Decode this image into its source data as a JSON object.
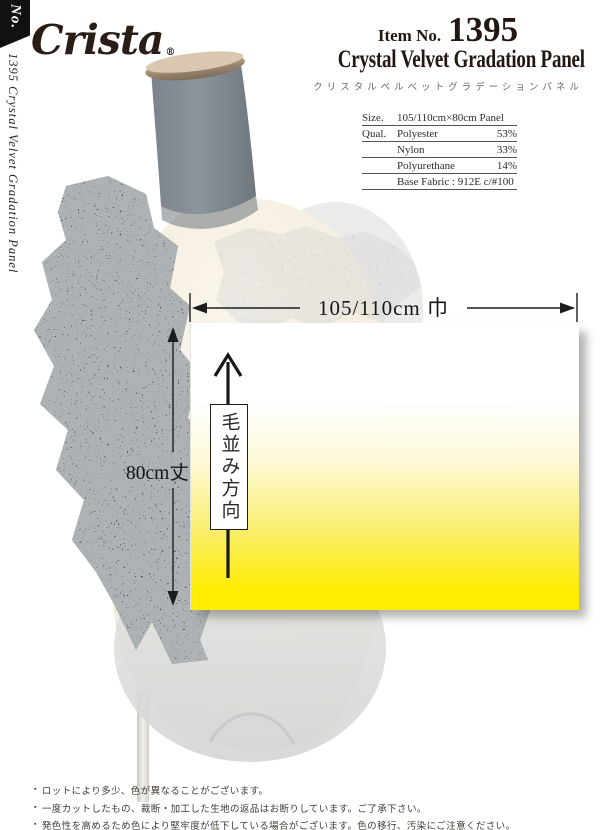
{
  "brand": {
    "logo_text": "Crista",
    "registered_mark": "®"
  },
  "sidebar": {
    "no_label": "No.",
    "vertical_title": "1395 Crystal Velvet Gradation Panel"
  },
  "header": {
    "item_no_label": "Item No.",
    "item_no_value": "1395",
    "title_en": "Crystal Velvet Gradation Panel",
    "title_ja": "クリスタルベルベットグラデーションパネル"
  },
  "spec_table": {
    "rows": [
      {
        "label": "Size.",
        "name": "105/110cm×80cm Panel",
        "value": ""
      },
      {
        "label": "Qual.",
        "name": "Polyester",
        "value": "53%"
      },
      {
        "label": "",
        "name": "Nylon",
        "value": "33%"
      },
      {
        "label": "",
        "name": "Polyurethane",
        "value": "14%"
      },
      {
        "label": "",
        "name": "Base Fabric : 912E c/#100",
        "value": ""
      }
    ]
  },
  "diagram": {
    "width_label": "105/110cm 巾",
    "height_label": "80cm丈",
    "nap_direction_label": "毛並み方向",
    "gradient_top_color": "#ffffff",
    "gradient_bottom_color": "#ffec00"
  },
  "footnotes": {
    "bullet": "▪",
    "items": [
      "ロットにより多少、色が異なることがございます。",
      "一度カットしたもの、裁断・加工した生地の返品はお断りしています。ご了承下さい。",
      "発色性を高めるため色により堅牢度が低下している場合がございます。色の移行、汚染にご注意ください。"
    ]
  },
  "colors": {
    "lace_dark": "#4d555a",
    "neck_gray": "#8b9398",
    "cap_tan": "#a8937c",
    "torso_ivory": "#f6f0e4",
    "title_ink": "#241711"
  }
}
